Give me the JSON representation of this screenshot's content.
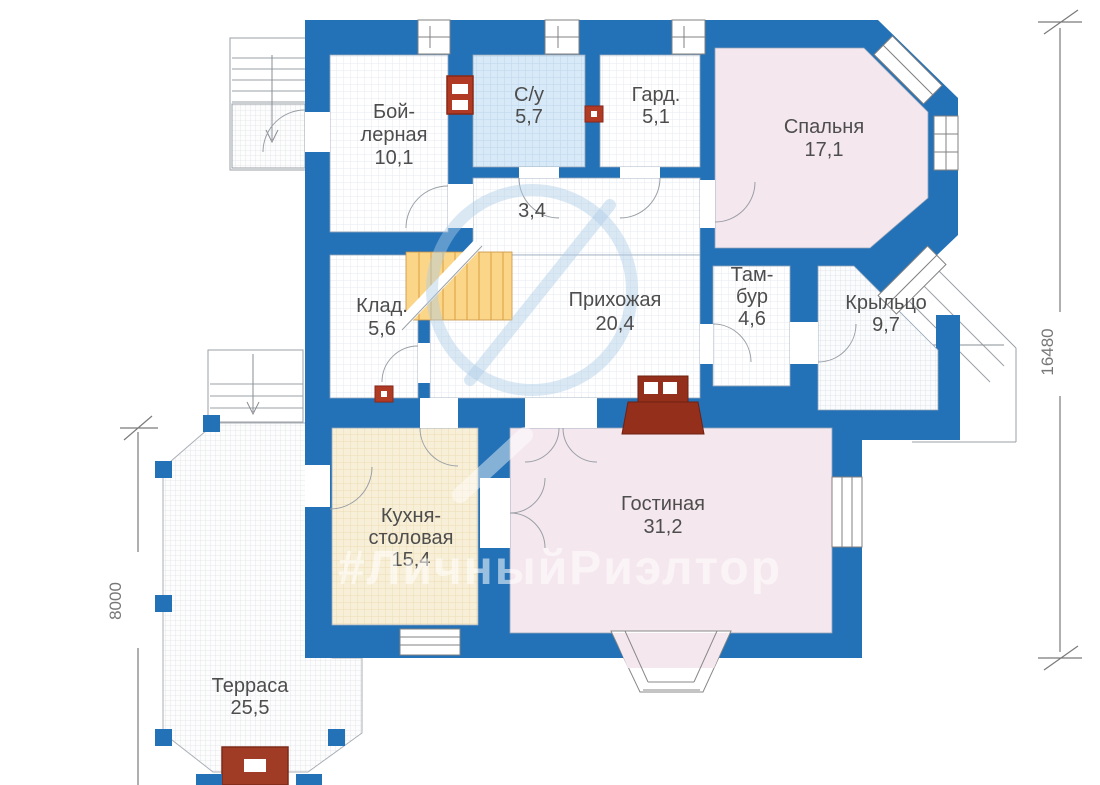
{
  "plan": {
    "watermark_text": "#ЛичныйРиэлтор",
    "rooms": {
      "boiler": {
        "name_line1": "Бой-",
        "name_line2": "лерная",
        "area": "10,1"
      },
      "bathroom": {
        "name": "С/у",
        "area": "5,7"
      },
      "wardrobe": {
        "name": "Гард.",
        "area": "5,1"
      },
      "bedroom": {
        "name": "Спальня",
        "area": "17,1"
      },
      "inner_hall": {
        "area": "3,4"
      },
      "storage": {
        "name": "Клад.",
        "area": "5,6"
      },
      "hallway": {
        "name": "Прихожая",
        "area": "20,4"
      },
      "vestibule": {
        "name_line1": "Там-",
        "name_line2": "бур",
        "area": "4,6"
      },
      "porch": {
        "name": "Крыльцо",
        "area": "9,7"
      },
      "kitchen": {
        "name_line1": "Кухня-",
        "name_line2": "столовая",
        "area": "15,4"
      },
      "living": {
        "name": "Гостиная",
        "area": "31,2"
      },
      "terrace": {
        "name": "Терраса",
        "area": "25,5"
      }
    },
    "dimensions": {
      "right_total": "16480",
      "left_terrace": "8000"
    },
    "colors": {
      "wall_blue": "#2371b7",
      "bedroom_fill": "#f5e7ee",
      "bathroom_fill": "#d8eaf8",
      "kitchen_fill": "#f8efd8",
      "stairs_fill": "#fbd688",
      "fixture_red": "#a03b25"
    }
  }
}
